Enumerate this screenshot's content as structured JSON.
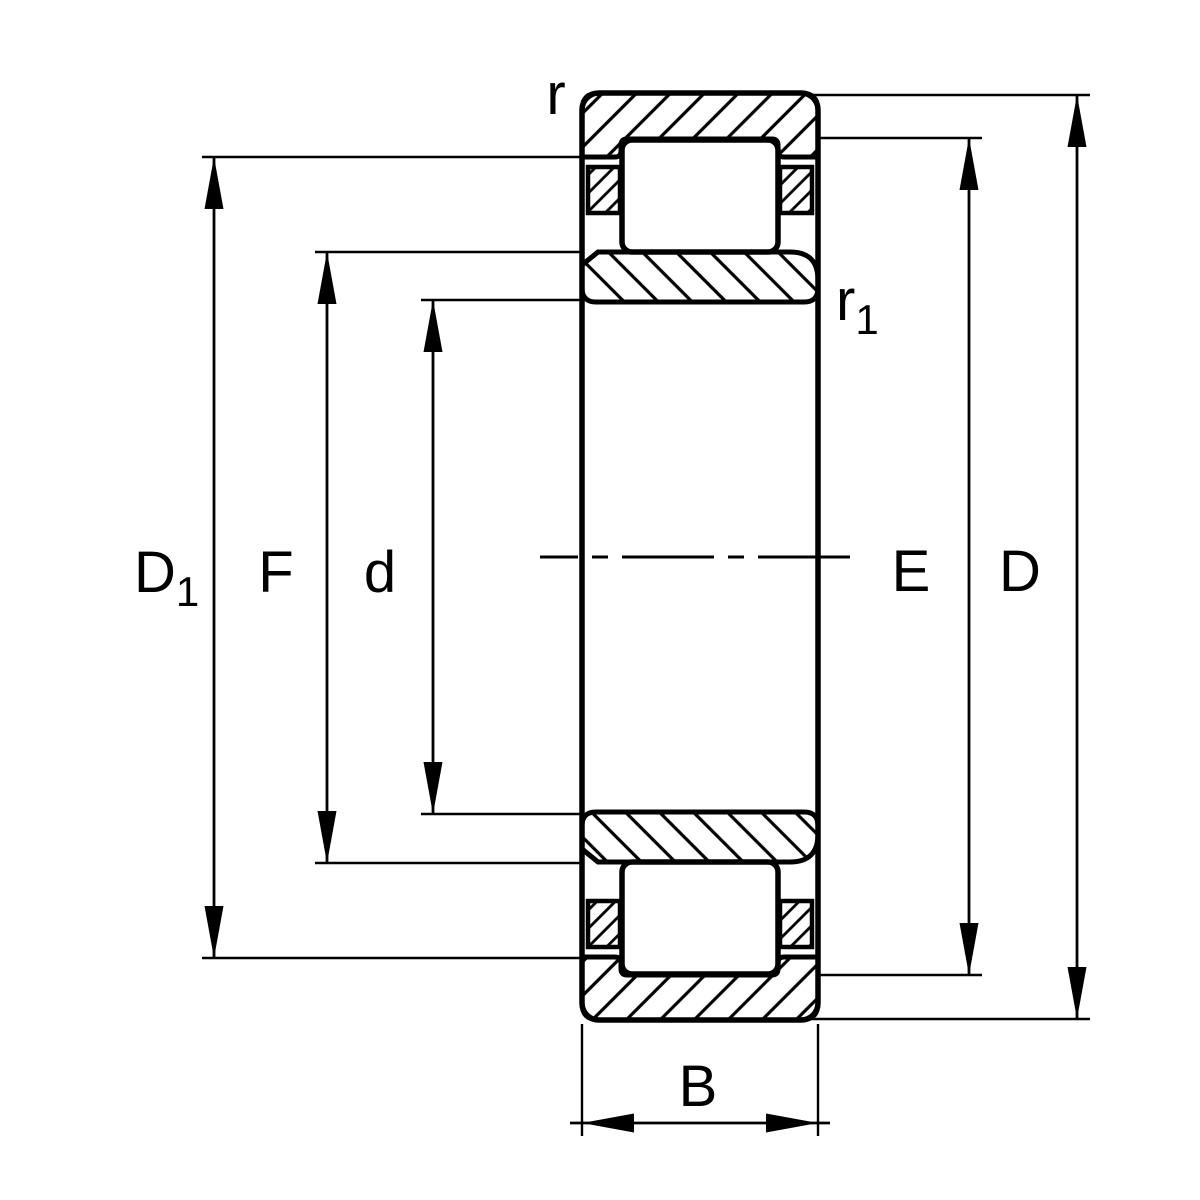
{
  "page": {
    "background": "#ffffff",
    "line_color": "#000000",
    "title": "Cylindrical roller bearing cross-section dimension drawing"
  },
  "drawing": {
    "labels": {
      "r": "r",
      "r1": {
        "main": "r",
        "sub": "1"
      },
      "D1": {
        "main": "D",
        "sub": "1"
      },
      "F": "F",
      "d": "d",
      "E": "E",
      "D": "D",
      "B": "B"
    }
  }
}
